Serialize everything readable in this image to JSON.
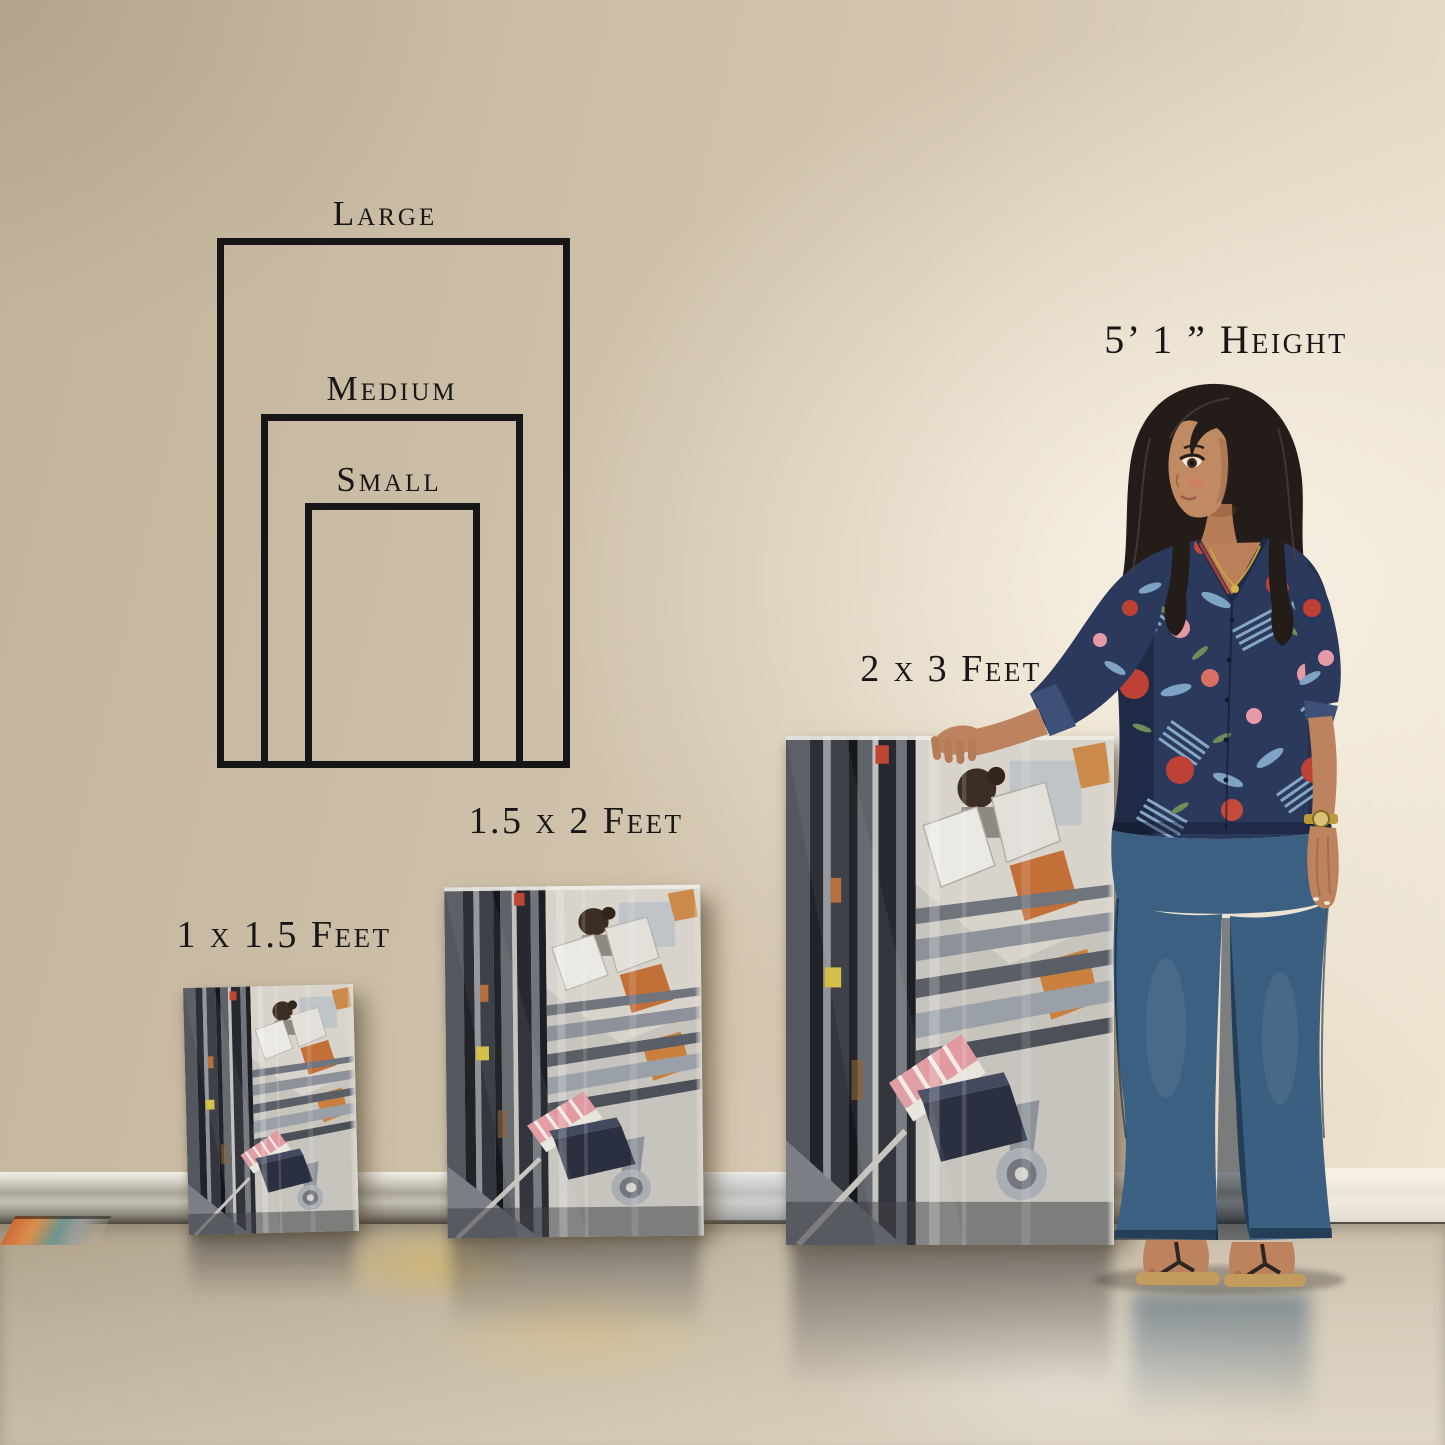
{
  "size_diagram": {
    "options": [
      {
        "id": "large",
        "label": "Large"
      },
      {
        "id": "medium",
        "label": "Medium"
      },
      {
        "id": "small",
        "label": "Small"
      }
    ]
  },
  "scale_reference": {
    "person_height_label": "5’ 1 ” Height"
  },
  "canvas_sizes": [
    {
      "id": "small",
      "label": "1 x 1.5 Feet"
    },
    {
      "id": "medium",
      "label": "1.5 x 2 Feet"
    },
    {
      "id": "large",
      "label": "2 x 3 Feet"
    }
  ],
  "palette": {
    "wall": "#cdbfa7",
    "wall_highlight": "#f2ebdc",
    "floor": "#cfc3ac",
    "outline": "#161616",
    "text": "#171717",
    "blouse_navy": "#2b3a5c",
    "flower_red": "#bf4136",
    "flower_pink": "#e59aa6",
    "leaf_blue": "#7fa3c4",
    "jeans_blue": "#3b6082",
    "skin": "#bd835f",
    "hair": "#231c19",
    "sandal_tan": "#c29c5e",
    "watch_gold": "#b99b3e"
  }
}
